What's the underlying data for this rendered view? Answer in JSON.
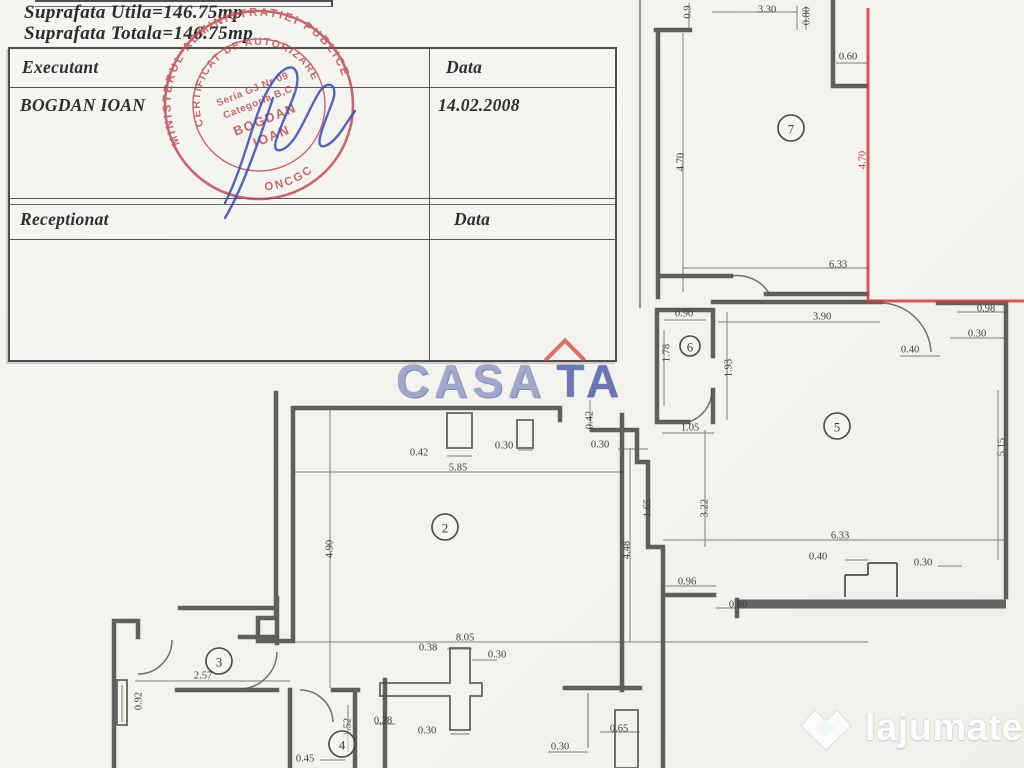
{
  "header": {
    "line1": "Suprafata  Utila=146.75mp",
    "line2": "Suprafata  Totala=146.75mp"
  },
  "table": {
    "executant_label": "Executant",
    "data_label_1": "Data",
    "executant_name": "BOGDAN IOAN",
    "date_value": "14.02.2008",
    "receptionat_label": "Receptionat",
    "data_label_2": "Data"
  },
  "stamp": {
    "ring_top": "MINISTERUL ADMINISTRATIEI PUBLICE",
    "ring_bottom": "ONCGC",
    "cert_line": "CERTIFICAT DE AUTORIZARE",
    "seria": "Seria GJ Nr 09",
    "categoria": "Categoria B,C",
    "name1": "BOGDAN",
    "name2": "IOAN",
    "color": "#b5474e"
  },
  "watermark_center": {
    "word1": "CASA",
    "word2": "TA"
  },
  "watermark_corner": {
    "brand": "lajumate",
    "tld": ".ro"
  },
  "colors": {
    "wall": "#4a4a4a",
    "red_line": "#c84040",
    "signature": "#3a4da8",
    "stamp": "#b5474e",
    "watermark_blue": "#505ba8",
    "tld_blue": "#a9dde8"
  },
  "plan": {
    "rooms": [
      {
        "n": "2",
        "x": 445,
        "y": 527
      },
      {
        "n": "3",
        "x": 219,
        "y": 661
      },
      {
        "n": "4",
        "x": 342,
        "y": 744
      },
      {
        "n": "5",
        "x": 837,
        "y": 426
      },
      {
        "n": "6",
        "x": 690,
        "y": 346
      },
      {
        "n": "7",
        "x": 791,
        "y": 128
      }
    ],
    "dims": [
      {
        "t": "0.9",
        "x": 688,
        "y": 12,
        "r": -90
      },
      {
        "t": "3.30",
        "x": 767,
        "y": 10
      },
      {
        "t": "0.80",
        "x": 807,
        "y": 16,
        "r": -90
      },
      {
        "t": "0.60",
        "x": 848,
        "y": 57
      },
      {
        "t": "4.70",
        "x": 681,
        "y": 162,
        "r": -90
      },
      {
        "t": "4.70",
        "x": 863,
        "y": 160,
        "r": -90,
        "red": true
      },
      {
        "t": "6.33",
        "x": 838,
        "y": 265
      },
      {
        "t": "0.90",
        "x": 684,
        "y": 314
      },
      {
        "t": "1.78",
        "x": 667,
        "y": 353,
        "r": -90
      },
      {
        "t": "1.93",
        "x": 729,
        "y": 368,
        "r": -90
      },
      {
        "t": "1.05",
        "x": 690,
        "y": 428
      },
      {
        "t": "3.90",
        "x": 822,
        "y": 317
      },
      {
        "t": "0.98",
        "x": 986,
        "y": 309
      },
      {
        "t": "0.30",
        "x": 977,
        "y": 334
      },
      {
        "t": "0.40",
        "x": 910,
        "y": 350
      },
      {
        "t": "5.15",
        "x": 1002,
        "y": 447,
        "r": -90
      },
      {
        "t": "6.33",
        "x": 840,
        "y": 536
      },
      {
        "t": "0.40",
        "x": 818,
        "y": 557
      },
      {
        "t": "0.30",
        "x": 923,
        "y": 563
      },
      {
        "t": "0.96",
        "x": 687,
        "y": 582
      },
      {
        "t": "0.80",
        "x": 738,
        "y": 605
      },
      {
        "t": "0.42",
        "x": 590,
        "y": 420,
        "r": -90
      },
      {
        "t": "0.30",
        "x": 600,
        "y": 445
      },
      {
        "t": "1.65",
        "x": 648,
        "y": 508,
        "r": -90
      },
      {
        "t": "3.22",
        "x": 705,
        "y": 508,
        "r": -90
      },
      {
        "t": "4.48",
        "x": 627,
        "y": 550,
        "r": -90
      },
      {
        "t": "0.42",
        "x": 419,
        "y": 453
      },
      {
        "t": "0.30",
        "x": 504,
        "y": 446
      },
      {
        "t": "5.85",
        "x": 458,
        "y": 468
      },
      {
        "t": "4.90",
        "x": 330,
        "y": 549,
        "r": -90
      },
      {
        "t": "8.05",
        "x": 465,
        "y": 638
      },
      {
        "t": "2.57",
        "x": 203,
        "y": 676
      },
      {
        "t": "0.92",
        "x": 139,
        "y": 701,
        "r": -90
      },
      {
        "t": "0.38",
        "x": 428,
        "y": 648
      },
      {
        "t": "0.30",
        "x": 497,
        "y": 655
      },
      {
        "t": "0.28",
        "x": 383,
        "y": 721
      },
      {
        "t": "0.30",
        "x": 427,
        "y": 731
      },
      {
        "t": "1.52",
        "x": 348,
        "y": 727,
        "r": -90
      },
      {
        "t": "0.45",
        "x": 305,
        "y": 759
      },
      {
        "t": "0.65",
        "x": 619,
        "y": 729
      },
      {
        "t": "0.30",
        "x": 560,
        "y": 747
      }
    ]
  }
}
